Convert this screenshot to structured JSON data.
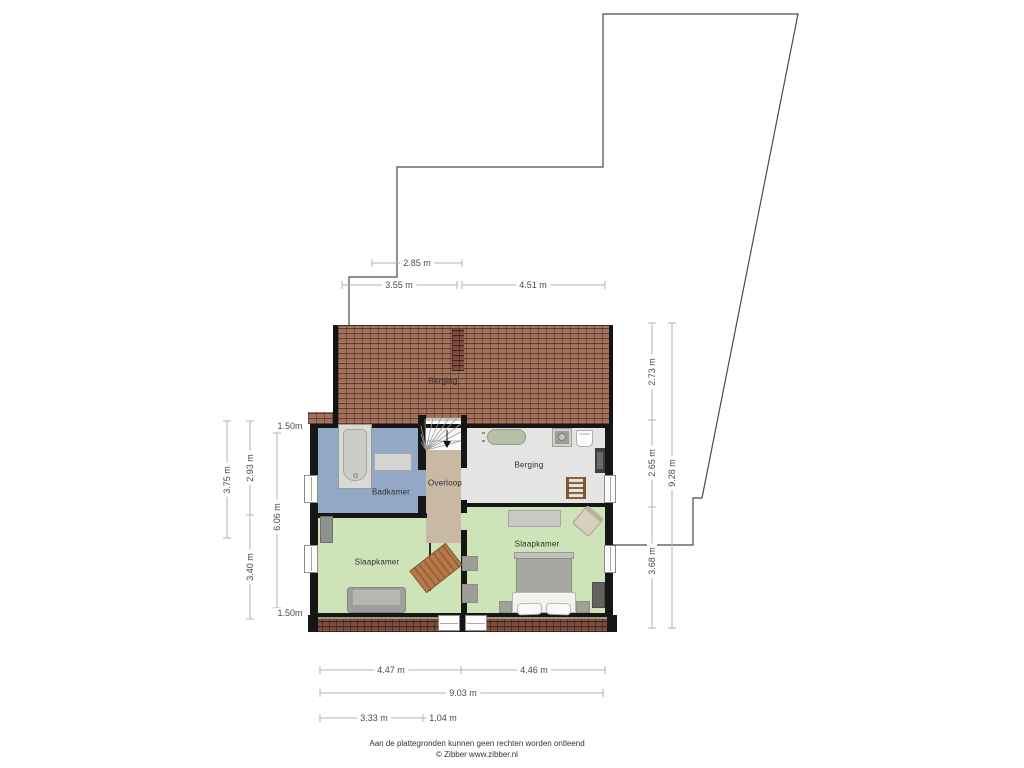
{
  "plan_type": "floorplan",
  "rooms": {
    "roof_attic": "Berging",
    "badkamer": "Badkamer",
    "overloop": "Overloop",
    "berging": "Berging",
    "slaapkamer_left": "Slaapkamer",
    "slaapkamer_right": "Slaapkamer"
  },
  "dimensions": {
    "top": [
      "2.85 m",
      "3.55 m",
      "4.51 m"
    ],
    "left": [
      "3.75 m",
      "2.93 m",
      "3.40 m",
      "1.50m",
      "6.06 m",
      "1.50m"
    ],
    "right": [
      "2.73 m",
      "2.65 m",
      "3.68 m",
      "9.28 m"
    ],
    "bottom": [
      "4.47 m",
      "4.46 m",
      "9.03 m",
      "3.33 m",
      "1.04 m"
    ]
  },
  "footer": {
    "disclaimer": "Aan de plattegronden kunnen geen rechten worden ontleend",
    "credit": "© Zibber www.zibber.nl"
  },
  "colors": {
    "roof_brick": "#a1705a",
    "roof_edge_brick": "#7b4c3d",
    "bathroom": "#92a8c6",
    "landing": "#c9b8a3",
    "storage": "#e4e4e2",
    "bedroom": "#cfe3b8",
    "wall": "#161616",
    "dimension_line": "#b3b3b3",
    "outline": "#4a4a4a"
  }
}
